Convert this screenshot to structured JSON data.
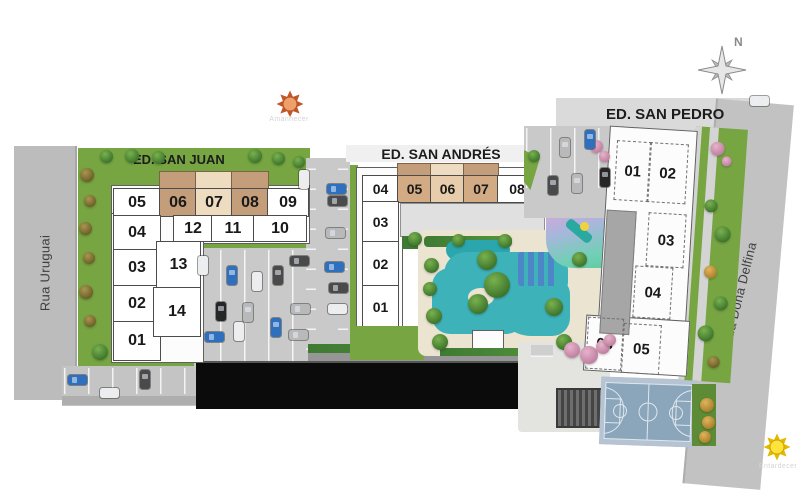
{
  "compass": {
    "label": "N"
  },
  "suns": {
    "sunrise": {
      "icon": "sun-orange-icon",
      "label": "Amanhecer"
    },
    "sunset": {
      "icon": "sun-yellow-icon",
      "label": "Entardecer"
    }
  },
  "streets": {
    "left": {
      "name": "Rua Uruguai"
    },
    "right": {
      "name": "Rua Dona Delfina"
    }
  },
  "buildings": {
    "san_juan": {
      "name": "ED. SAN JUAN",
      "row_top": [
        "05",
        "06",
        "07",
        "08",
        "09"
      ],
      "row_mid": [
        "12",
        "11",
        "10"
      ],
      "col_left": [
        "04",
        "03",
        "02",
        "01"
      ],
      "col_inner": [
        "13",
        "14"
      ],
      "highlighted_units": [
        "06",
        "07",
        "08"
      ]
    },
    "san_andres": {
      "name": "ED. SAN ANDRÉS",
      "row_top": [
        "04",
        "05",
        "06",
        "07",
        "08"
      ],
      "col_left": [
        "03",
        "02",
        "01"
      ],
      "highlighted_units": [
        "05",
        "06",
        "07"
      ]
    },
    "san_pedro": {
      "name": "ED. SAN PEDRO",
      "col_top": [
        "01",
        "02"
      ],
      "col_mid": [
        "03",
        "04"
      ],
      "row_bottom": [
        "06",
        "05"
      ]
    }
  },
  "icons": {
    "compass-rose": "eight-point star",
    "sun-sunrise": "orange sun",
    "sun-sunset": "yellow sun",
    "car": "parked car",
    "tree": "round tree canopy"
  },
  "amenities": [
    "pool",
    "playground",
    "basketball-court",
    "pergola",
    "parking"
  ],
  "colors": {
    "site_green": "#76a542",
    "road_gray": "#bcbcbc",
    "pool_teal": "#3db2b8",
    "unit_highlight_tan": "#c49e7a",
    "unit_highlight_cream": "#eddcc0",
    "court_blue": "#8ba5bb",
    "dark_building": "#0b0b0b",
    "sun_orange": "#efa068",
    "sun_yellow": "#ffe33b"
  }
}
